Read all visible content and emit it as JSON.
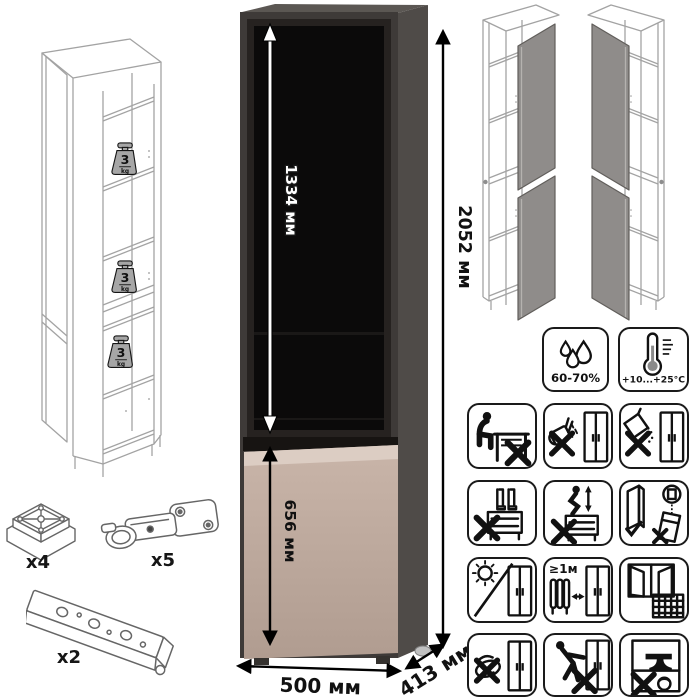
{
  "product": {
    "dimensions": {
      "total_height": "2052 мм",
      "glass_section_height": "1334 мм",
      "lower_door_height": "656 мм",
      "width": "500 мм",
      "depth": "413 мм"
    },
    "shelf_load": {
      "value": "3",
      "unit": "kg"
    }
  },
  "hardware": {
    "foot": {
      "qty": "x4"
    },
    "hinge": {
      "qty": "x5"
    },
    "rail": {
      "qty": "x2"
    }
  },
  "care": {
    "humidity_range": "60-70%",
    "temperature_range": "+10...+25°C",
    "heater_min_distance": "≥1м",
    "calendar_day": "21"
  },
  "colors": {
    "carcass_dark": "#3e3a38",
    "side_panel": "#4f4b48",
    "glass_black": "#0b0a0a",
    "door_taupe": "#bca89c",
    "door_highlight": "#dccdc3",
    "wireframe_line": "#a3a3a3",
    "pair_door_gray": "#8f8c8a",
    "weight_badge_gray": "#a6a6a6"
  },
  "icons": {
    "climate": [
      "humidity-icon",
      "temperature-icon"
    ],
    "warnings": [
      "no-sitting-icon",
      "no-pouring-liquid-icon",
      "no-spilling-powder-icon",
      "no-standing-icon",
      "no-jumping-icon",
      "door-adjustment-icon",
      "no-direct-sunlight-icon",
      "heater-distance-icon",
      "room-ventilation-icon",
      "no-abrasive-cleaning-icon",
      "no-pushing-icon",
      "no-heavy-items-icon"
    ]
  }
}
